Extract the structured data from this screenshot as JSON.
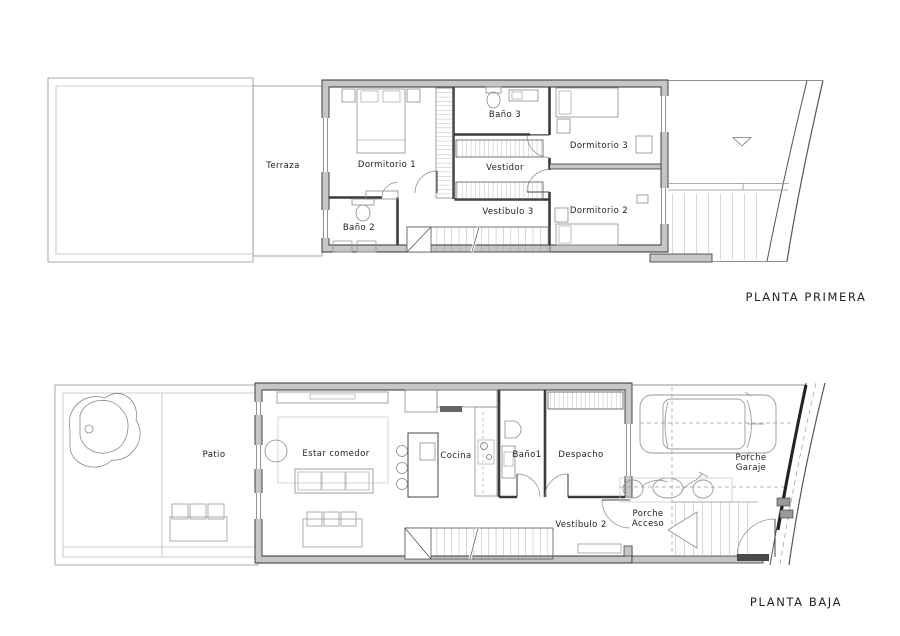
{
  "document": {
    "type": "architectural floor plan drawing",
    "background": "#ffffff"
  },
  "colors": {
    "wall_fill": "#c6c6c6",
    "wall_outline": "#333333",
    "furniture_line": "#8a8a8a",
    "site_line": "#a8a8a8",
    "dark_detail": "#4a4a4a"
  },
  "plans": {
    "primera": {
      "title": "PLANTA PRIMERA",
      "rooms": {
        "terraza": "Terraza",
        "dormitorio1": "Dormitorio 1",
        "bano2": "Baño 2",
        "bano3": "Baño 3",
        "vestidor": "Vestidor",
        "vestibulo3": "Vestíbulo 3",
        "dormitorio3": "Dormitorio 3",
        "dormitorio2": "Dormitorio 2"
      }
    },
    "baja": {
      "title": "PLANTA BAJA",
      "rooms": {
        "patio": "Patio",
        "estar_comedor": "Estar comedor",
        "cocina": "Cocina",
        "bano1": "Baño1",
        "despacho": "Despacho",
        "vestibulo2": "Vestíbulo 2",
        "porche_acceso": "Porche Acceso",
        "porche_garaje": "Porche Garaje"
      }
    }
  }
}
